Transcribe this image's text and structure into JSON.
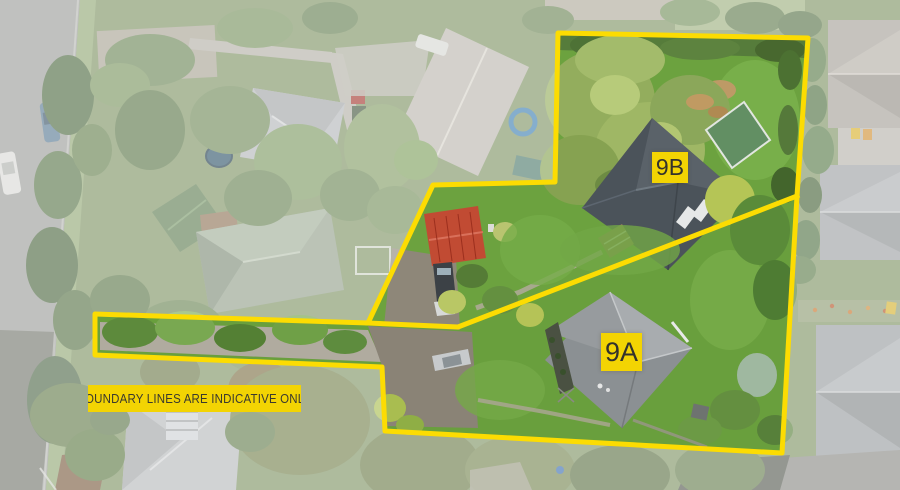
{
  "image_type": "aerial-property-photo",
  "labels": {
    "lot_b": "9B",
    "lot_a": "9A"
  },
  "disclaimer_text": "BOUNDARY LINES ARE INDICATIVE ONLY",
  "colors": {
    "boundary_yellow": "#FCDC02",
    "label_background": "#F3D403",
    "label_text": "#33322C",
    "vivid_lawn": "#6CA23F",
    "red_garage_roof": "#C14B33",
    "dark_house_roof": "#4B535A",
    "light_house_roof": "#8B9093"
  },
  "boundary": {
    "outer": "558,33 808,38 797,196 782,453 385,431 382,367 95,355 95,314 368,323 433,185 555,182",
    "divider": "368,323 458,327 797,196"
  }
}
